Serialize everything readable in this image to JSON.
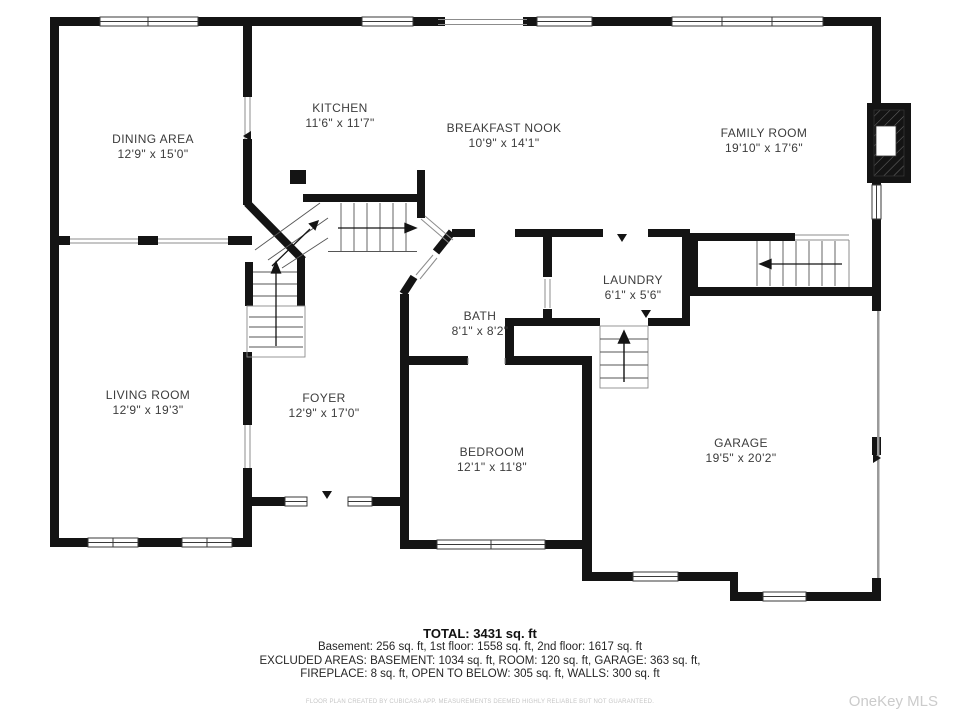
{
  "floor_plan": {
    "rooms": [
      {
        "id": "dining-area",
        "name": "DINING AREA",
        "dims": "12'9\" x 15'0\""
      },
      {
        "id": "kitchen",
        "name": "KITCHEN",
        "dims": "11'6\" x 11'7\""
      },
      {
        "id": "breakfast-nook",
        "name": "BREAKFAST NOOK",
        "dims": "10'9\" x 14'1\""
      },
      {
        "id": "family-room",
        "name": "FAMILY ROOM",
        "dims": "19'10\" x 17'6\""
      },
      {
        "id": "laundry",
        "name": "LAUNDRY",
        "dims": "6'1\" x 5'6\""
      },
      {
        "id": "bath",
        "name": "BATH",
        "dims": "8'1\" x 8'2\""
      },
      {
        "id": "living-room",
        "name": "LIVING ROOM",
        "dims": "12'9\" x 19'3\""
      },
      {
        "id": "foyer",
        "name": "FOYER",
        "dims": "12'9\" x 17'0\""
      },
      {
        "id": "bedroom",
        "name": "BEDROOM",
        "dims": "12'1\" x 11'8\""
      },
      {
        "id": "garage",
        "name": "GARAGE",
        "dims": "19'5\" x 20'2\""
      }
    ]
  },
  "summary": {
    "total": "TOTAL: 3431 sq. ft",
    "line1": "Basement: 256 sq. ft, 1st floor: 1558 sq. ft, 2nd floor: 1617 sq. ft",
    "line2": "EXCLUDED AREAS: BASEMENT: 1034 sq. ft, ROOM: 120 sq. ft, GARAGE: 363 sq. ft,",
    "line3": "FIREPLACE: 8 sq. ft, OPEN TO BELOW: 305 sq. ft, WALLS: 300 sq. ft"
  },
  "footer": {
    "disclaimer": "FLOOR PLAN CREATED BY CUBICASA APP. MEASUREMENTS DEEMED HIGHLY RELIABLE BUT NOT GUARANTEED.",
    "watermark": "OneKey MLS"
  },
  "colors": {
    "wall": "#141414",
    "window_border": "#3a3a3a",
    "railing": "#8c8c8c",
    "label_text": "#3c3c3c",
    "watermark_text": "#cbcbcb"
  }
}
